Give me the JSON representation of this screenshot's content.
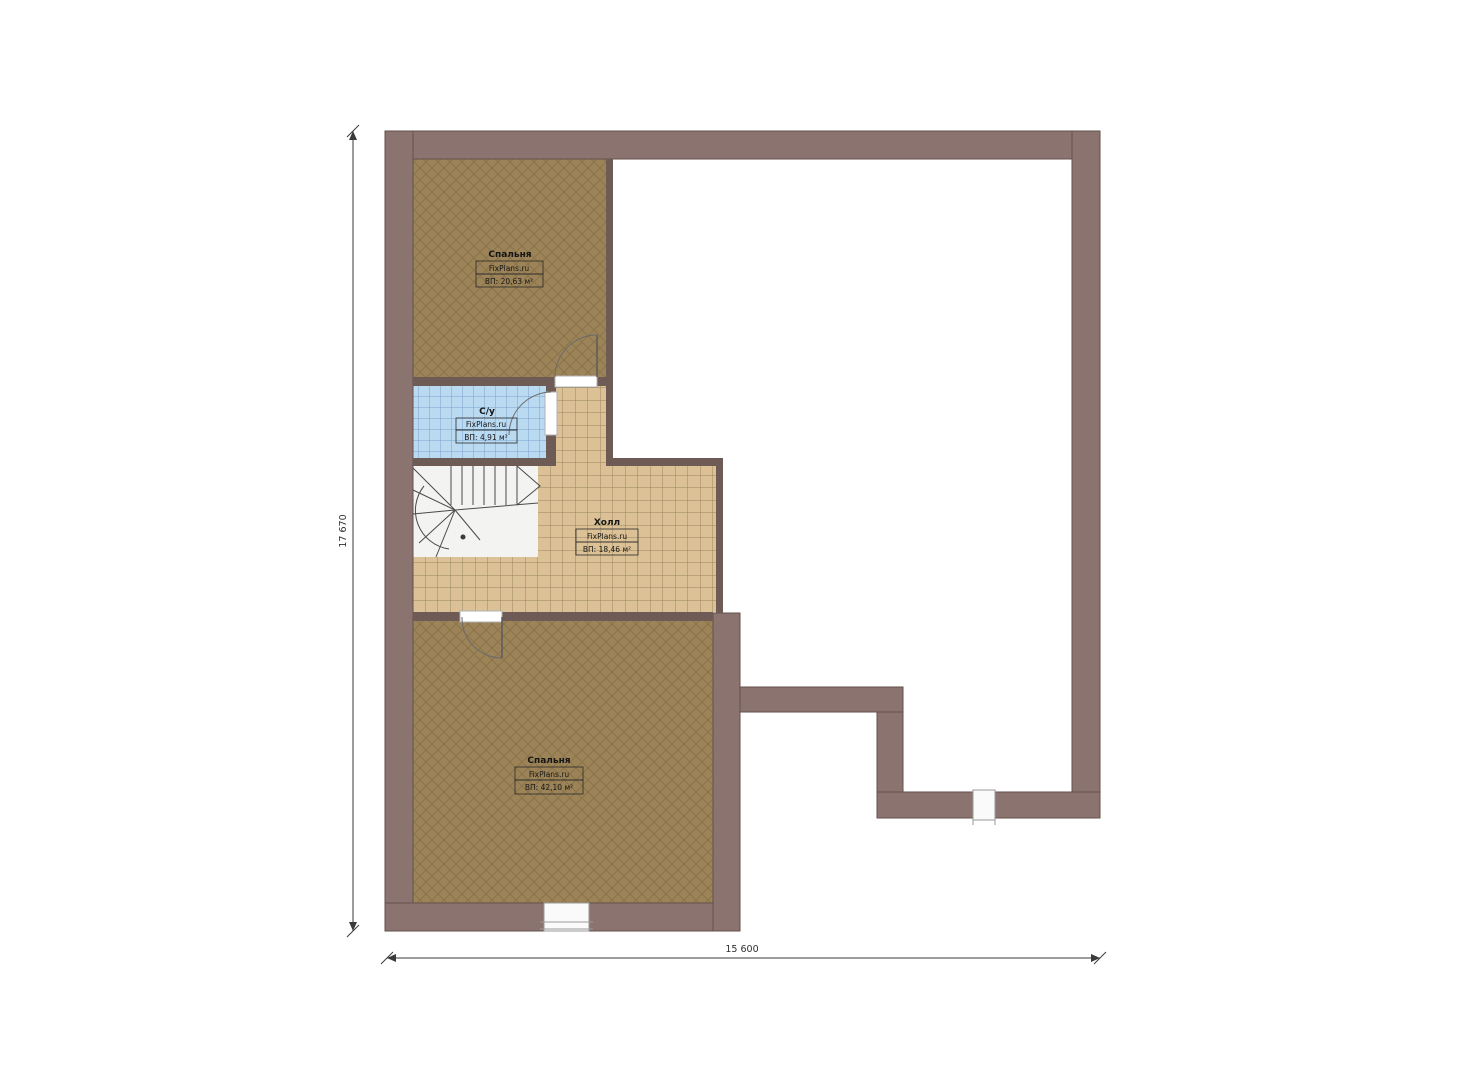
{
  "plan": {
    "type": "floor-plan",
    "site_brand": "FixPlans.ru",
    "rooms": [
      {
        "id": "bedroom-top",
        "name": "Спальня",
        "brand": "FixPlans.ru",
        "area": "ВП: 20,63 м²"
      },
      {
        "id": "bathroom",
        "name": "С/у",
        "brand": "FixPlans.ru",
        "area": "ВП: 4,91 м²"
      },
      {
        "id": "hall",
        "name": "Холл",
        "brand": "FixPlans.ru",
        "area": "ВП: 18,46 м²"
      },
      {
        "id": "bedroom-bottom",
        "name": "Спальня",
        "brand": "FixPlans.ru",
        "area": "ВП: 42,10 м²"
      }
    ],
    "dimensions": {
      "vertical": "17 670",
      "horizontal": "15 600"
    },
    "colors": {
      "wall": "#8b7470",
      "wall_outline": "#63514d",
      "interior_wall": "#6f5b56",
      "bedroom_floor": "#9c8358",
      "bedroom_hatch": "#5e4a28",
      "bathroom_floor": "#badaf2",
      "bathroom_grid": "#7aa3cb",
      "hall_floor": "#dbc195",
      "hall_grid": "#84744f",
      "stair_area": "#f3f3f1",
      "stair_line": "#4a4a4a",
      "dimension_line": "#3a3a3a"
    }
  }
}
